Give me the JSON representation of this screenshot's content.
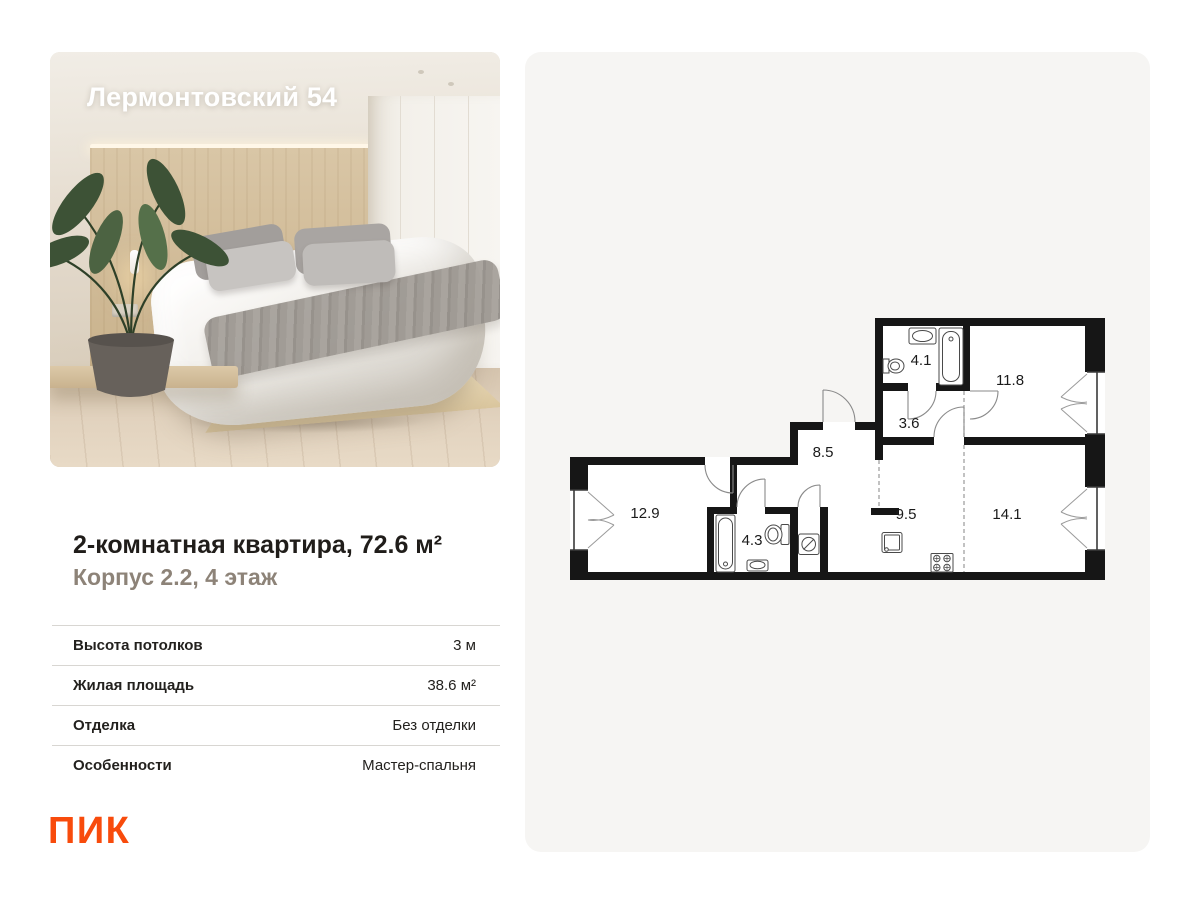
{
  "photo_card": {
    "title": "Лермонтовский 54"
  },
  "listing": {
    "title": "2-комнатная квартира, 72.6 м²",
    "subtitle": "Корпус 2.2, 4 этаж",
    "specs": [
      {
        "label": "Высота потолков",
        "value": "3 м"
      },
      {
        "label": "Жилая площадь",
        "value": "38.6 м²"
      },
      {
        "label": "Отделка",
        "value": "Без отделки"
      },
      {
        "label": "Особенности",
        "value": "Мастер-спальня"
      }
    ],
    "logo": "ПИК"
  },
  "floor_plan": {
    "rooms": [
      {
        "name": "bathroom-top",
        "area": "4.1"
      },
      {
        "name": "bedroom-top-right",
        "area": "11.8"
      },
      {
        "name": "inner-hall",
        "area": "3.6"
      },
      {
        "name": "hallway",
        "area": "8.5"
      },
      {
        "name": "bedroom-left",
        "area": "12.9"
      },
      {
        "name": "bathroom-bottom",
        "area": "4.3"
      },
      {
        "name": "kitchen",
        "area": "9.5"
      },
      {
        "name": "living-room",
        "area": "14.1"
      }
    ]
  },
  "colors": {
    "brand_orange": "#F84B0C",
    "plan_card_bg": "#F6F5F3",
    "plan_walls": "#161616",
    "subtitle_gray": "#8D8378"
  }
}
